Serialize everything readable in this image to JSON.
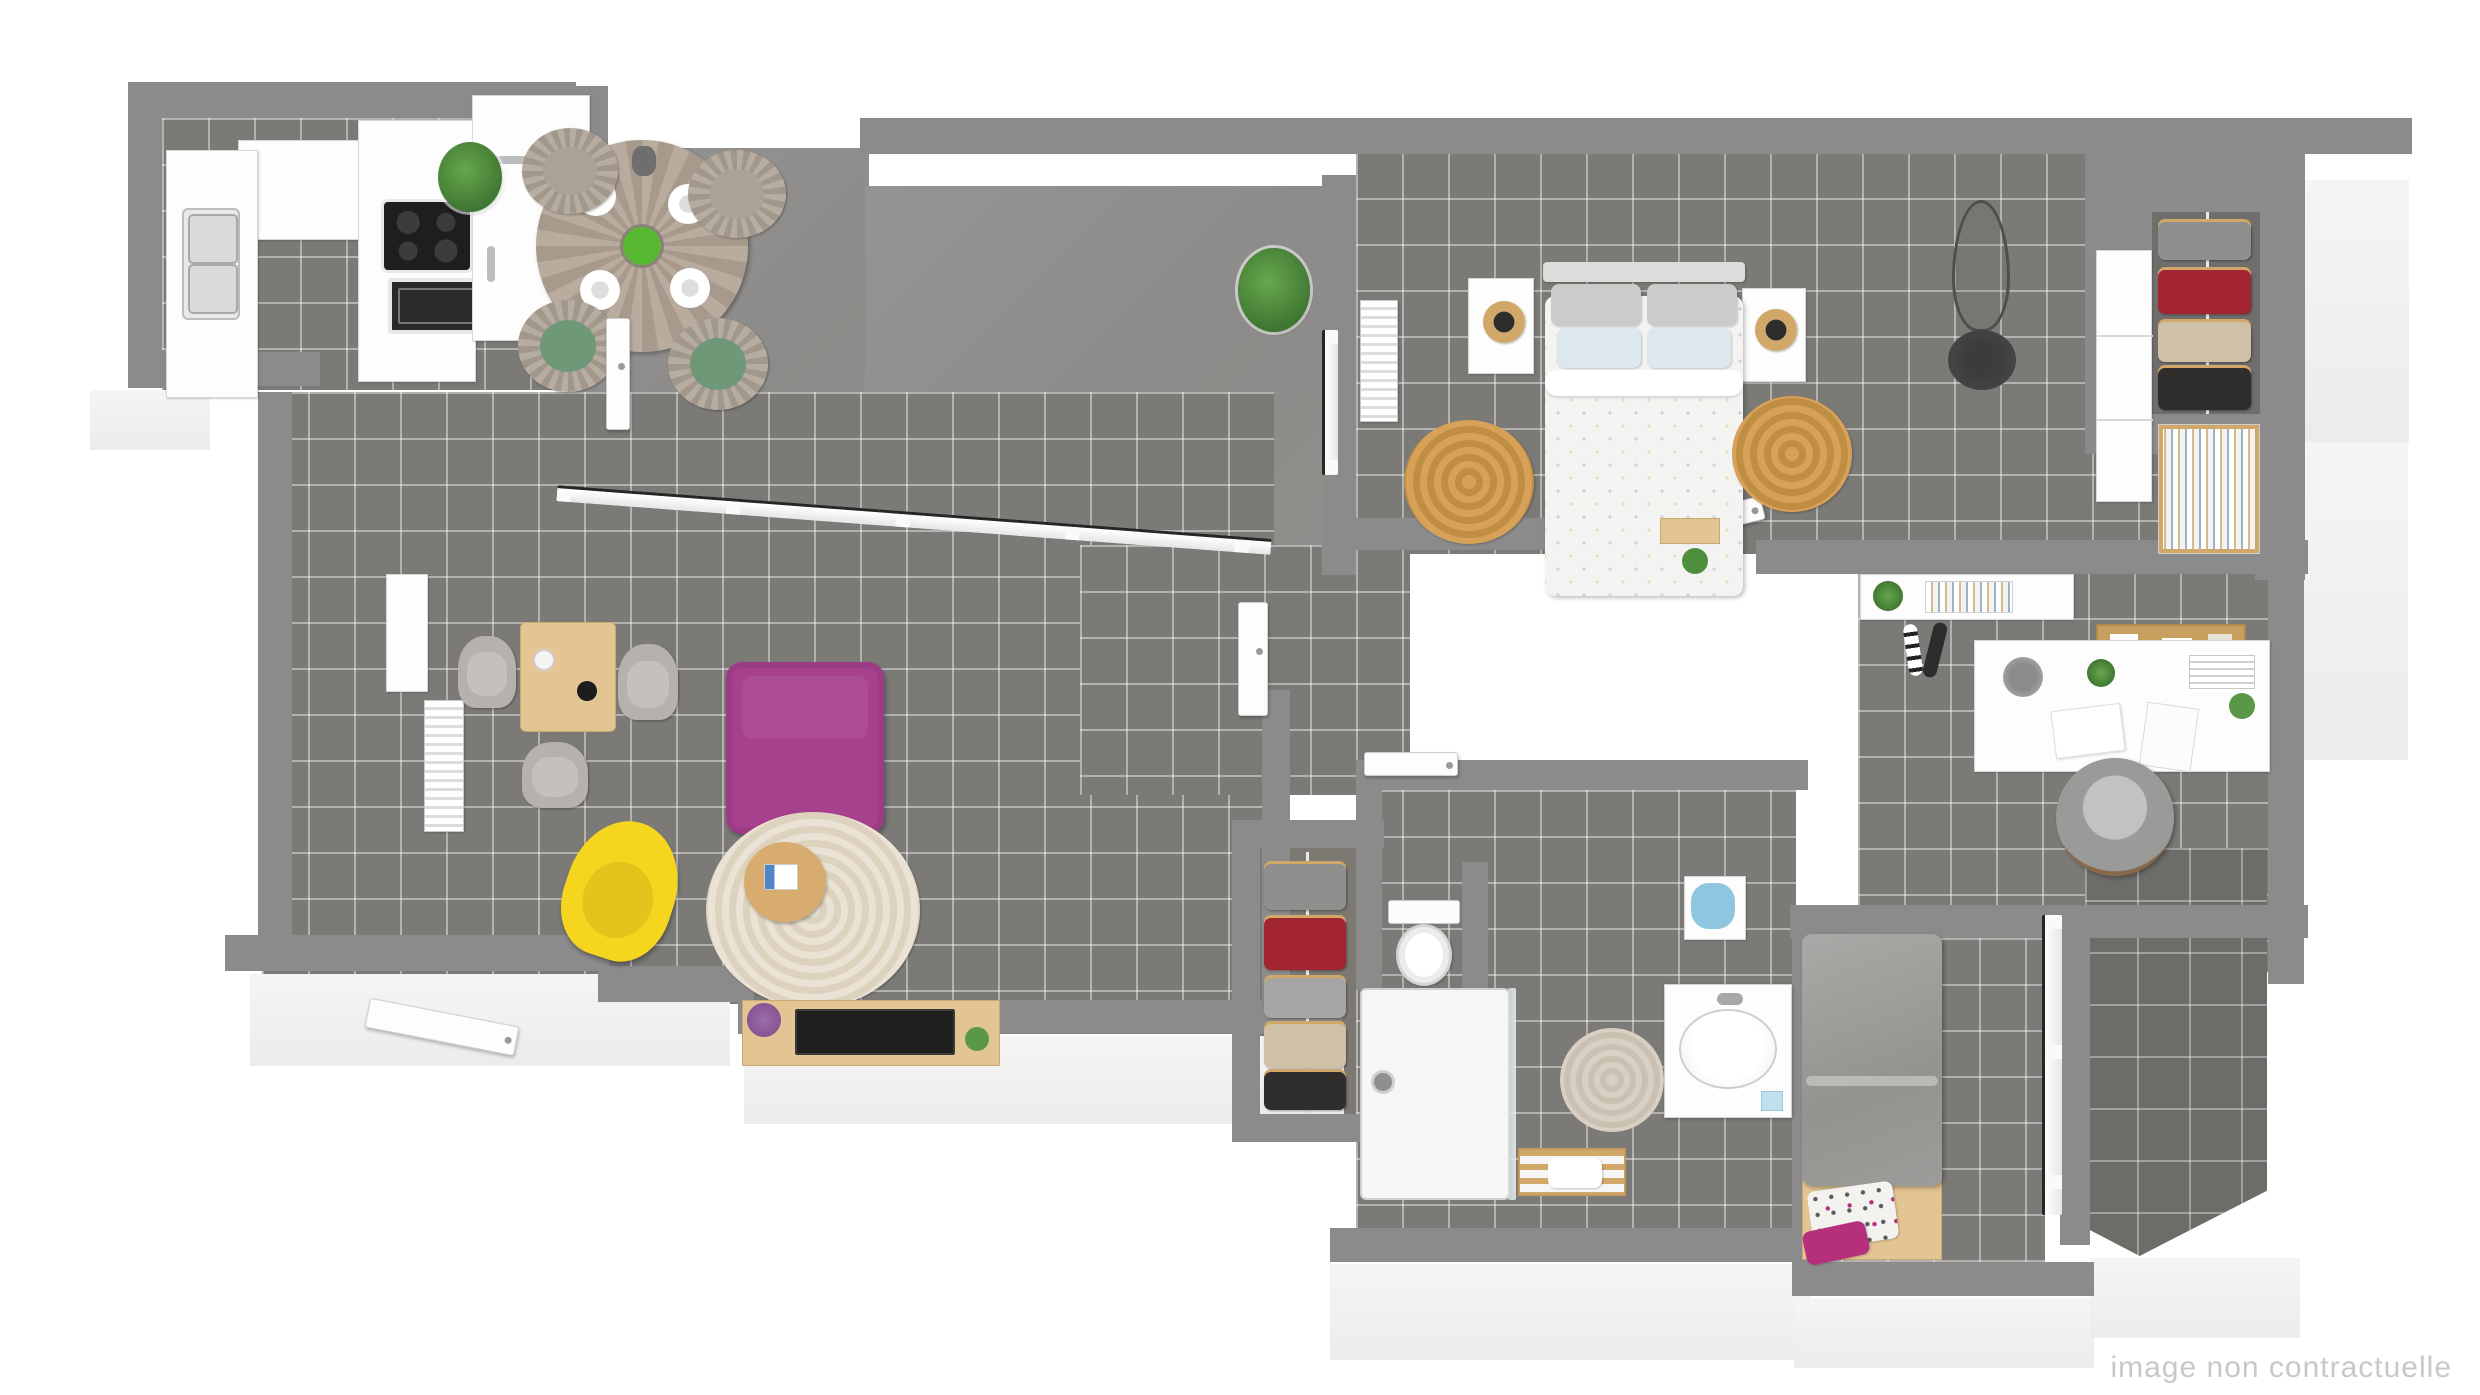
{
  "watermark": "image non contractuelle",
  "scene": {
    "type": "3d-floor-plan-render",
    "rooms": [
      "kitchen",
      "terrace",
      "living-room",
      "hallway",
      "master-bedroom",
      "dressing-closet",
      "office",
      "bathroom",
      "second-bedroom",
      "balcony"
    ],
    "furniture": {
      "kitchen": [
        "counter",
        "double-sink",
        "induction-cooktop",
        "oven",
        "fridge-column"
      ],
      "terrace": [
        "round-dining-table",
        "fan-chair-x4",
        "green-cushions",
        "place-settings",
        "fruit-bowl",
        "potted-plant-x2"
      ],
      "living-room": [
        "wood-table",
        "shell-chair-x3",
        "purple-sofa",
        "yellow-armchair",
        "round-rug",
        "coffee-table",
        "tv-console",
        "tv",
        "radiator-x2",
        "wall-mirror",
        "entrance-door"
      ],
      "master-bedroom": [
        "double-bed",
        "nightstand-x2",
        "rattan-lamp-x2",
        "jute-rug-x2",
        "radiator",
        "dress-form",
        "open-closet",
        "wardrobe",
        "bookshelf",
        "foot-bench"
      ],
      "office": [
        "desk",
        "desk-shelf",
        "corkboard",
        "desk-lamp",
        "desk-plant",
        "office-chair",
        "poster-tubes"
      ],
      "bathroom": [
        "toilet",
        "shower",
        "glass-screen",
        "vanity-basin",
        "round-rug",
        "towel-rack",
        "laundry-basket"
      ],
      "second-bedroom": [
        "single-bed",
        "patterned-pillow",
        "magenta-pillow",
        "balcony-window"
      ],
      "dressing-closet": [
        "clothes-rail",
        "hangers",
        "clothes"
      ]
    }
  },
  "colors": {
    "wall-top": "#8b8b8b",
    "floor": "#7c7a77",
    "balcony": "#6e6c69",
    "sofa": "#a7418e",
    "armchair": "#f6d51f",
    "cushion": "#6f9878",
    "wood-light": "#e3c493",
    "wood-mid": "#d2a76a",
    "jute": "#d7a158",
    "rug-living": "#eae2d4",
    "rug-bath": "#d9d0c3",
    "duvet": "#f3f3f1",
    "pillow-gray": "#cbcbc9",
    "pillow-blue": "#dde8ee",
    "duvet2": "#9c9c9a",
    "magenta": "#b52f7d",
    "clothes-red": "#a32532",
    "clothes-black": "#2f2e2d",
    "clothes-beige": "#cfc1a7",
    "clothes-gray": "#8f8f8d",
    "appliance": "#1e1e1e",
    "plant": "#67a74c",
    "plant-dark": "#2f6428",
    "watermark": "#c8c8c8"
  }
}
